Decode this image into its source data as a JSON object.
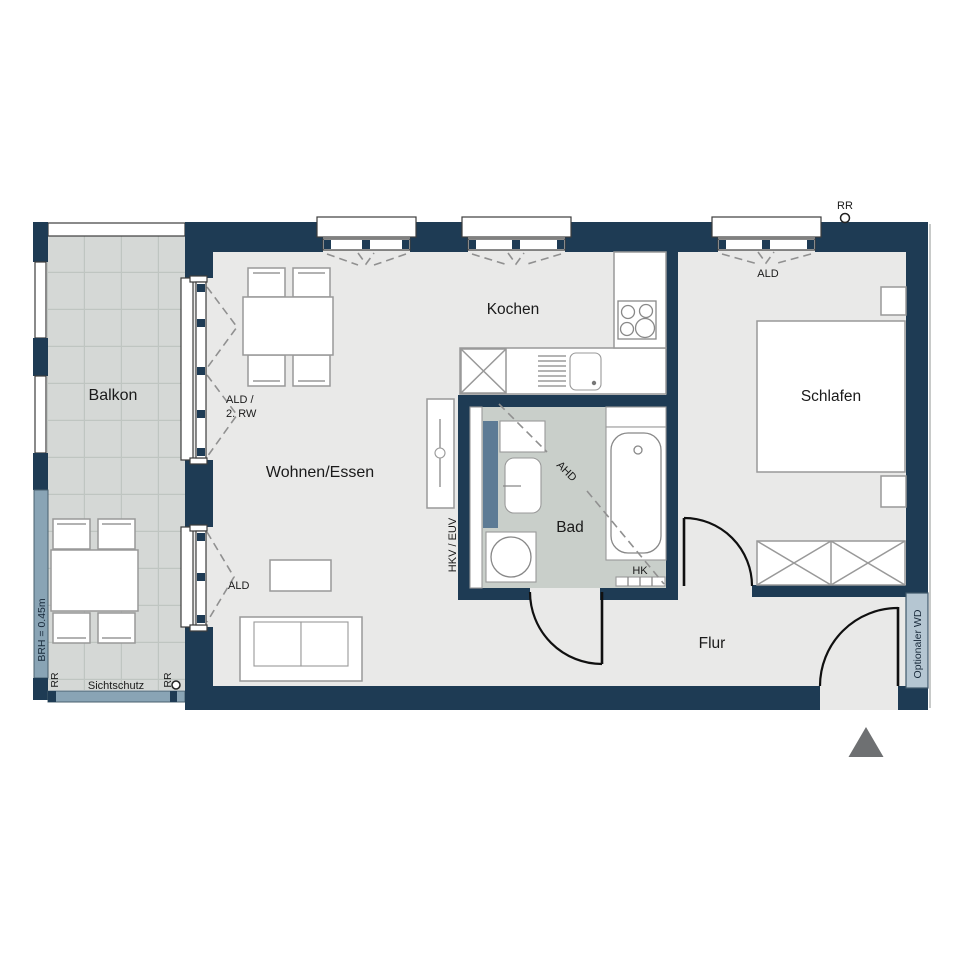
{
  "rooms": {
    "balkon": "Balkon",
    "wohnen_essen": "Wohnen/Essen",
    "kochen": "Kochen",
    "schlafen": "Schlafen",
    "bad": "Bad",
    "flur": "Flur"
  },
  "annotations": {
    "rr_roof": "RR",
    "ald_bedroom": "ALD",
    "ald_rw_line1": "ALD /",
    "ald_rw_line2": "2. RW",
    "ald_living": "ALD",
    "ahd": "AHD",
    "hkv_euv": "HKV / EUV",
    "hk": "HK",
    "brh": "BRH = 0.45m",
    "rr_balcony_left": "RR",
    "sichtschutz": "Sichtschutz",
    "rr_balcony_right": "RR",
    "optionaler_wd": "Optionaler WD"
  },
  "colors": {
    "wall": "#1e3b54",
    "floor": "#e9e9e8",
    "balcony-floor": "#d5d8d6",
    "balcony-grid": "#bfc5c1",
    "bad-floor": "#c9cfca",
    "band": "#89a4b5",
    "panel": "#5d7b95",
    "wd": "#b5c6d2",
    "furn": "#999999",
    "dash": "#909090",
    "door": "#101010",
    "tri": "#6e7072",
    "text": "#1a1a1a",
    "band-text": "#18293a"
  }
}
